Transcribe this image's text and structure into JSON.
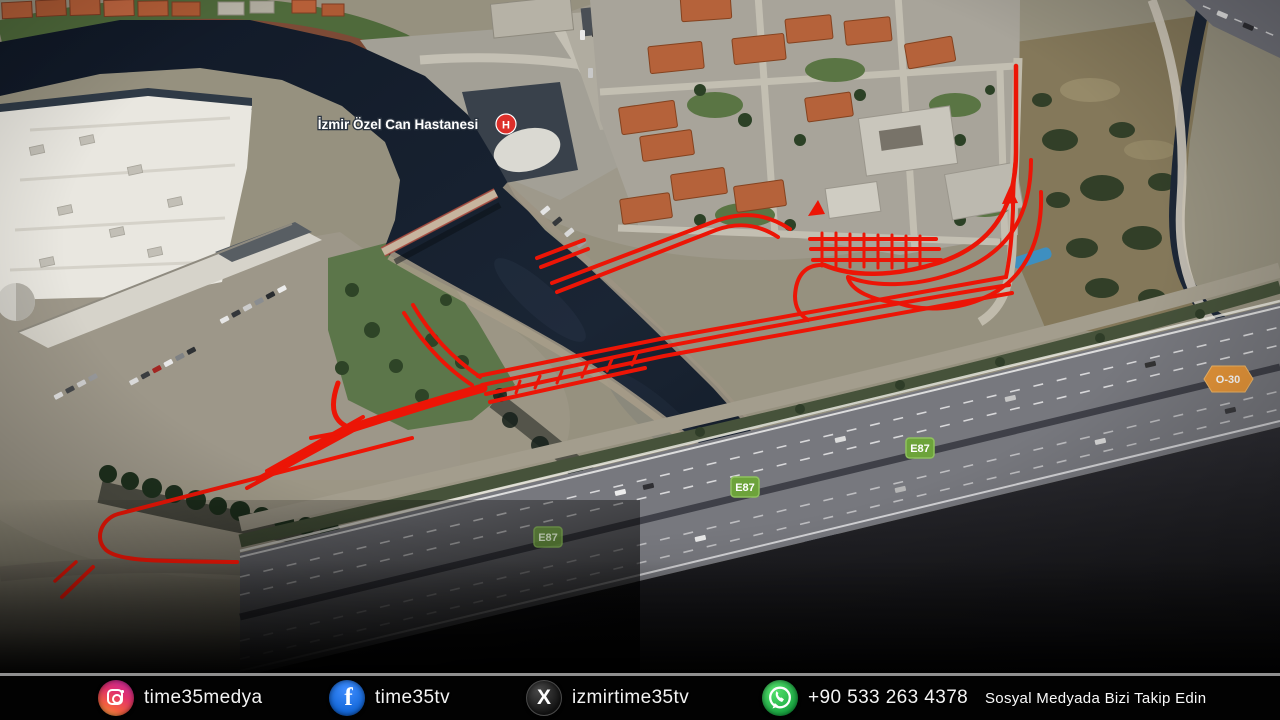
{
  "map": {
    "hospital_label": "İzmir Özel Can Hastanesi",
    "hospital_marker": "H",
    "badges": [
      {
        "label": "E87",
        "type": "green"
      },
      {
        "label": "E87",
        "type": "green"
      },
      {
        "label": "E87",
        "type": "green-dim"
      },
      {
        "label": "O-30",
        "type": "orange"
      }
    ],
    "colors": {
      "water": "#16202e",
      "route_overlay": "#ec1506",
      "land": "#96917f",
      "highway": "#77787e",
      "badge_green": "#6da33b",
      "badge_orange": "#e8973a",
      "hospital_marker_red": "#dd2f2a"
    }
  },
  "footer": {
    "items": [
      {
        "platform": "instagram",
        "handle": "time35medya"
      },
      {
        "platform": "facebook",
        "handle": "time35tv"
      },
      {
        "platform": "x",
        "handle": "izmirtime35tv"
      },
      {
        "platform": "whatsapp",
        "handle": "+90 533 263 4378"
      }
    ],
    "tagline": "Sosyal Medyada Bizi Takip Edin"
  }
}
